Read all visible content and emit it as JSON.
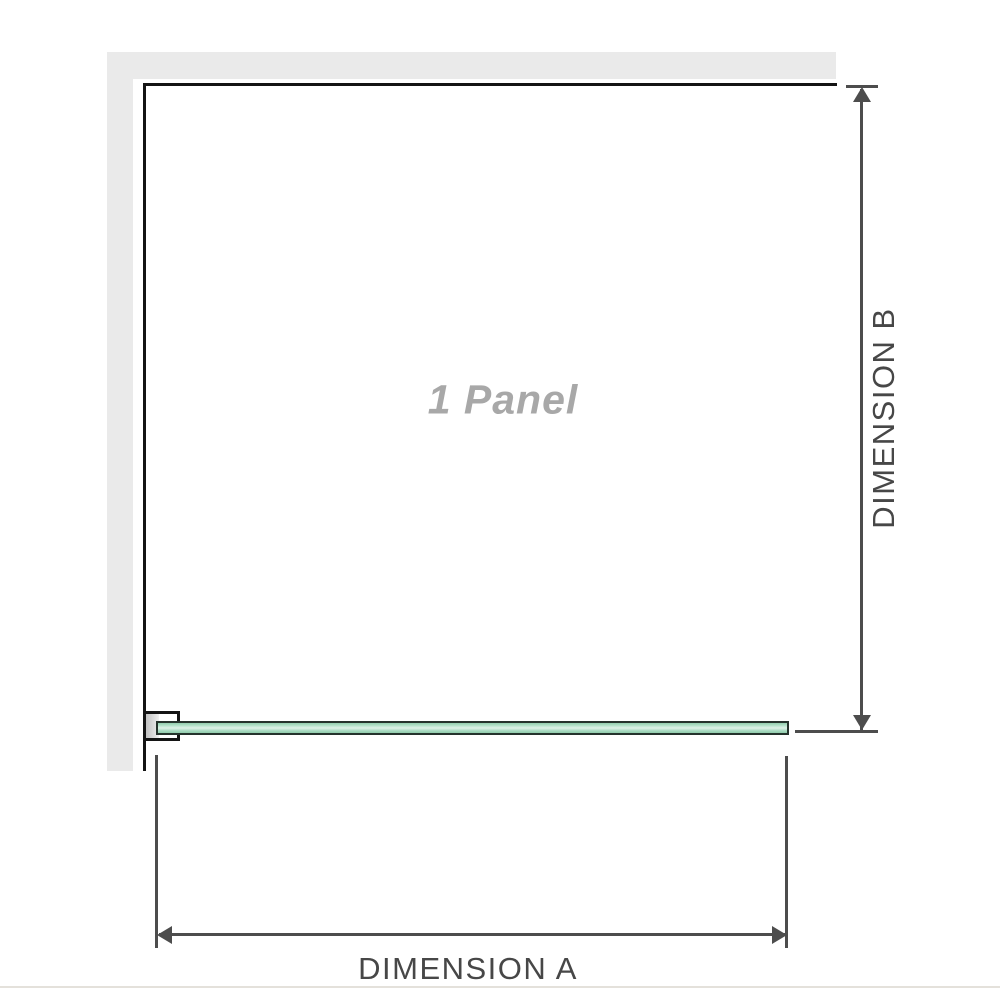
{
  "diagram": {
    "panel_label": "1 Panel",
    "dimension_a": {
      "label": "DIMENSION A",
      "orientation": "horizontal"
    },
    "dimension_b": {
      "label": "DIMENSION B",
      "orientation": "vertical"
    }
  },
  "icons": {
    "arrow_up": "up-arrowhead",
    "arrow_down": "down-arrowhead",
    "arrow_left": "left-arrowhead",
    "arrow_right": "right-arrowhead"
  },
  "colors": {
    "background": "#ffffff",
    "wall": "#eaeaea",
    "panel_outline": "#141414",
    "dimension_line": "#4d4d4d",
    "dimension_text": "#474747",
    "panel_label_text": "#a8a8a8",
    "glass_border": "#25332c",
    "glass_green": "#92cdad",
    "glass_green_highlight": "#dff3e8",
    "bracket_pad": "#c2c2c2",
    "image_baseline": "#e4e1db"
  }
}
